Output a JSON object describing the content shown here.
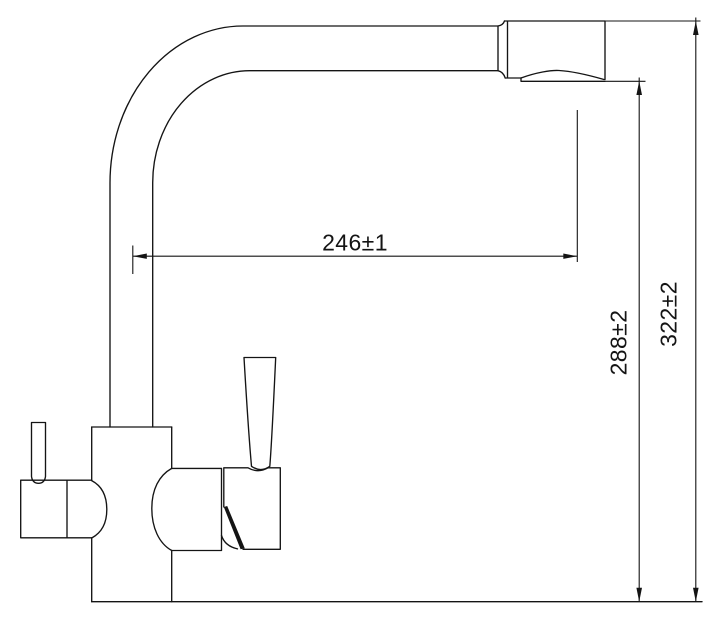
{
  "drawing": {
    "type": "technical-drawing",
    "subject": "faucet-side-view",
    "colors": {
      "background": "#ffffff",
      "line": "#141414"
    },
    "dimensions": [
      {
        "id": "spout-reach",
        "label": "246±1",
        "value": 246,
        "tolerance": 1,
        "orientation": "horizontal"
      },
      {
        "id": "aerator-height",
        "label": "288±2",
        "value": 288,
        "tolerance": 2,
        "orientation": "vertical"
      },
      {
        "id": "overall-height",
        "label": "322±2",
        "value": 322,
        "tolerance": 2,
        "orientation": "vertical"
      }
    ]
  }
}
